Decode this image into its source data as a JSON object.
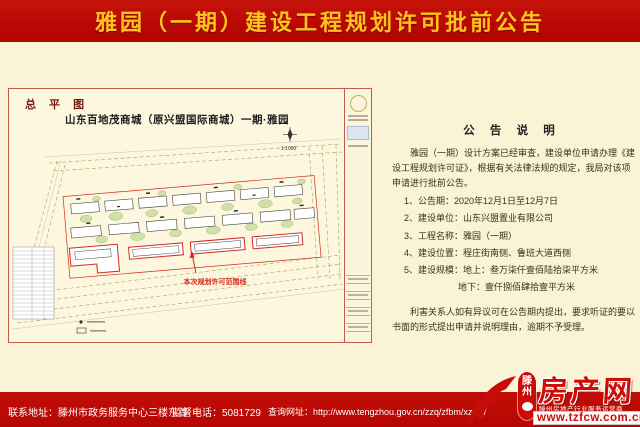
{
  "banner": {
    "title": "雅园（一期）建设工程规划许可批前公告"
  },
  "drawing": {
    "label": "总 平 图",
    "title": "山东百地茂商城（原兴盟国际商城）一期·雅园",
    "scale": "1:1000",
    "scope_annotation": "本次规划许可范围线"
  },
  "notice": {
    "title": "公 告 说 明",
    "intro": "雅园（一期）设计方案已经审查，建设单位申请办理《建设工程规划许可证》，根据有关法律法规的规定，我局对该项申请进行批前公告。",
    "items": [
      "1、公告期：2020年12月1日至12月7日",
      "2、建设单位：山东兴盟置业有限公司",
      "3、工程名称：雅园（一期）",
      "4、建设位置：程庄街南侧、鲁班大道西侧",
      "5、建设规模：地上：叁万柒仟壹佰陆拾柒平方米"
    ],
    "item5_sub": "地下：壹仟捌佰肆拾壹平方米",
    "outro": "利害关系人如有异议可在公告期内提出，要求听证的要以书面的形式提出申请并说明理由，逾期不予受理。"
  },
  "footer": {
    "address": "联系地址：滕州市政务服务中心三楼东首",
    "phone": "监督电话：5081729",
    "site": "查询网址：http://www.tengzhou.gov.cn/zzq/zfbm/xzspj/"
  },
  "logo": {
    "badge_top": "滕",
    "badge_bottom": "州",
    "name": "房产网",
    "tagline": "滕州房地产行业服务运营商",
    "url": "www.tzfcw.com.cn"
  },
  "colors": {
    "banner_red": "#BB0804",
    "banner_text": "#FFC31E",
    "page_cream": "#FAF3D6",
    "sheet_border": "#C05A4A",
    "scope_red": "#D42A1E",
    "logo_red": "#D00C06"
  }
}
